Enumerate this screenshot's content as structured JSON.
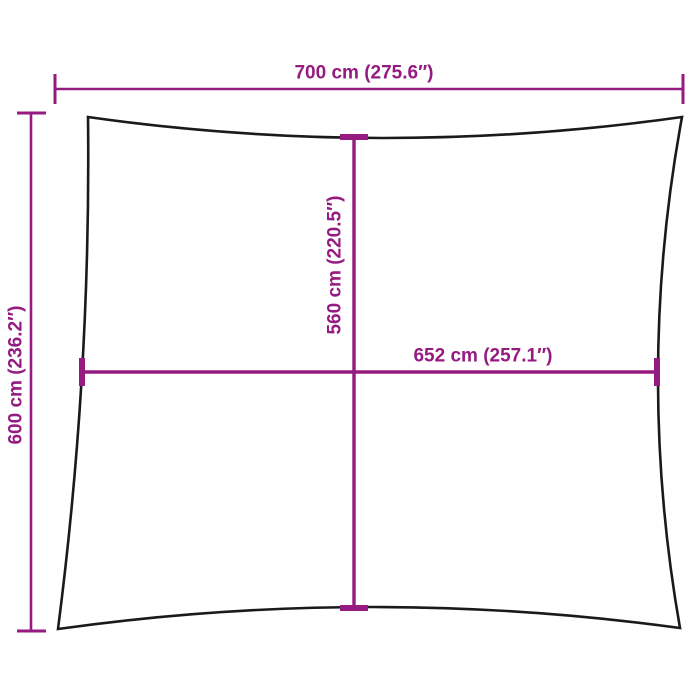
{
  "diagram": {
    "kind": "shade-sail-dimension-diagram",
    "labels": {
      "overall_width": "700 cm (275.6″)",
      "overall_height": "600 cm (236.2″)",
      "inner_height": "560 cm (220.5″)",
      "inner_width": "652 cm (257.1″)"
    },
    "colors": {
      "dimension": "#951B81",
      "outline": "#1A1A1A",
      "background": "#FFFFFF"
    }
  }
}
